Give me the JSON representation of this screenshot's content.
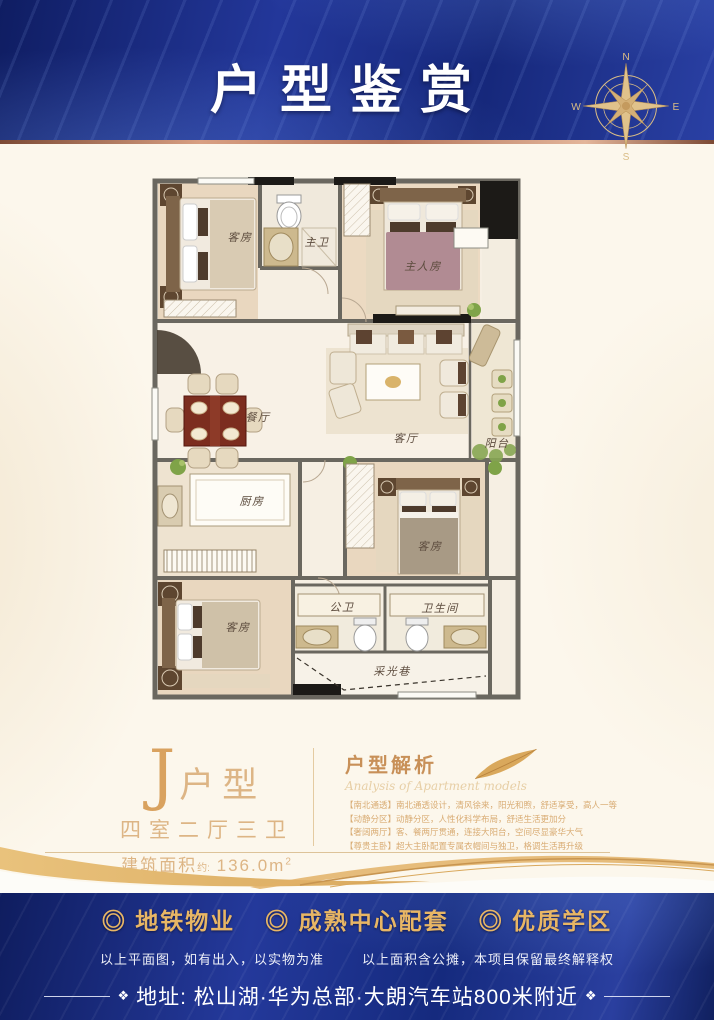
{
  "banner": {
    "title": "户型鉴赏"
  },
  "compass": {
    "n": "N",
    "e": "E",
    "s": "S",
    "w": "W"
  },
  "floor_plan": {
    "labels": {
      "bedroom_top": "客房",
      "master_bath": "主卫",
      "master_bedroom": "主人房",
      "dining": "餐厅",
      "living": "客厅",
      "balcony": "阳台",
      "kitchen": "厨房",
      "bedroom_mid": "客房",
      "bedroom_bottom": "客房",
      "public_bath": "公卫",
      "bathroom": "卫生间",
      "light_lane": "采光巷"
    }
  },
  "unit": {
    "letter": "J",
    "type_suffix": "户型",
    "rooms_desc": "四室二厅三卫",
    "area_prefix": "建筑面积",
    "area_approx": "约:",
    "area_value": " 136.0m",
    "area_sup": "2"
  },
  "analysis": {
    "title": "户型解析",
    "subtitle": "Analysis of Apartment models",
    "items": [
      "【南北通透】南北通透设计，清风徐来，阳光和煦，舒适享受，高人一等",
      "【动静分区】动静分区，人性化科学布局，舒适生活更加分",
      "【奢阔两厅】客、餐两厅贯通，连接大阳台，空间尽显豪华大气",
      "【尊贵主卧】超大主卧配置专属衣帽间与独卫，格调生活再升级"
    ]
  },
  "footer": {
    "highlights": [
      "◎ 地铁物业",
      "◎ 成熟中心配套",
      "◎ 优质学区"
    ],
    "disclaimer_left": "以上平面图，如有出入，以实物为准",
    "disclaimer_right": "以上面积含公摊，本项目保留最终解释权",
    "address": "地址: 松山湖·华为总部·大朗汽车站800米附近",
    "ornament": "❖"
  },
  "colors": {
    "banner_blue": "#1c2f85",
    "gold": "#d9a85c",
    "gold_text": "#ddb585",
    "footer_gold": "#e8b665",
    "cream": "#fcf7ec"
  }
}
